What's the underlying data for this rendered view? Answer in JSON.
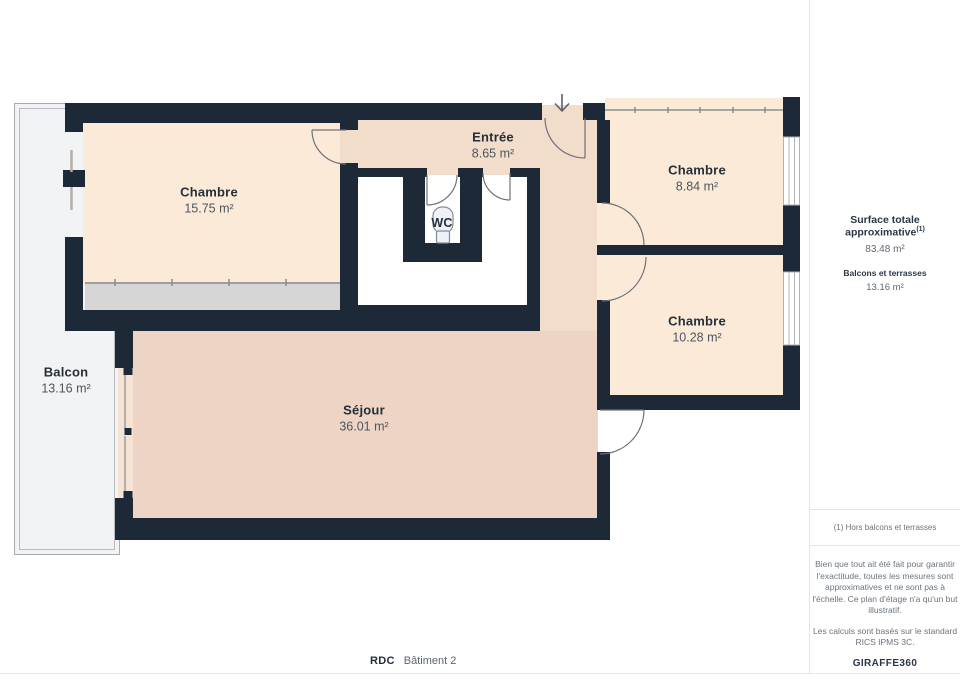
{
  "plan": {
    "rooms": {
      "chambre1": {
        "name": "Chambre",
        "area": "15.75 m²"
      },
      "entree": {
        "name": "Entrée",
        "area": "8.65 m²"
      },
      "chambre2": {
        "name": "Chambre",
        "area": "8.84 m²"
      },
      "chambre3": {
        "name": "Chambre",
        "area": "10.28 m²"
      },
      "sejour": {
        "name": "Séjour",
        "area": "36.01 m²"
      },
      "balcon": {
        "name": "Balcon",
        "area": "13.16 m²"
      },
      "wc": {
        "name": "WC"
      }
    }
  },
  "sidebar": {
    "surface_title": "Surface totale approximative",
    "surface_sup": "(1)",
    "surface_value": "83.48 m²",
    "balcony_title": "Balcons et terrasses",
    "balcony_value": "13.16 m²",
    "footnote": "(1) Hors balcons et terrasses",
    "disclaimer1": "Bien que tout ait été fait pour garantir l'exactitude, toutes les mesures sont approximatives et ne sont pas à l'échelle. Ce plan d'étage n'a qu'un but illustratif.",
    "disclaimer2": "Les calculs sont basés sur le standard RICS IPMS 3C.",
    "brand": "GIRAFFE",
    "brand_suffix": "360"
  },
  "footer": {
    "floor": "RDC",
    "building": "Bâtiment 2"
  },
  "colors": {
    "wall": "#1d2936",
    "chambre": "#fcead8",
    "entree": "#f2dcca",
    "sejour": "#eed4c5",
    "wc": "#e0e5ef",
    "wardrobe": "#d6d6d7",
    "balcon-fill": "#f2f3f4",
    "balcon-border": "#a8acb0"
  }
}
